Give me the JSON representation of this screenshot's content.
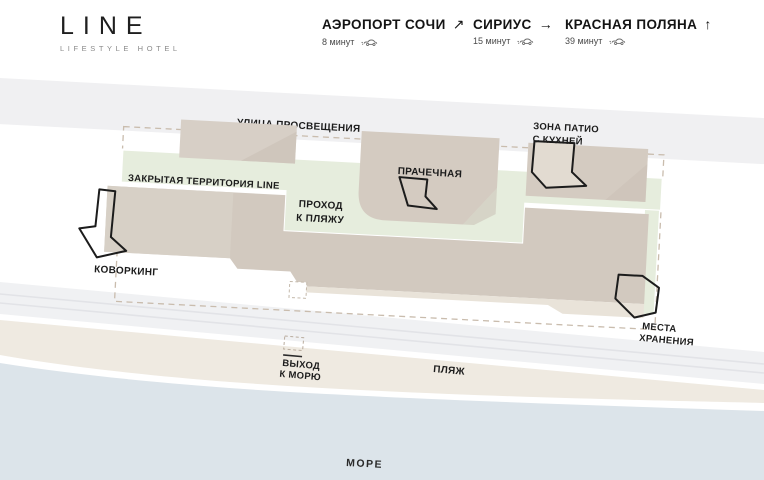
{
  "header": {
    "logo": {
      "title": "LINE",
      "subtitle": "LIFESTYLE HOTEL"
    },
    "destinations": [
      {
        "name": "АЭРОПОРТ СОЧИ",
        "arrow": "↗",
        "time": "8 минут",
        "icon": "car-icon"
      },
      {
        "name": "СИРИУС",
        "arrow": "→",
        "time": "15 минут",
        "icon": "car-icon"
      },
      {
        "name": "КРАСНАЯ ПОЛЯНА",
        "arrow": "↑",
        "time": "39 минут",
        "icon": "car-icon"
      }
    ]
  },
  "map": {
    "labels": {
      "street": "УЛИЦА ПРОСВЕЩЕНИЯ",
      "closed_territory": "ЗАКРЫТАЯ ТЕРРИТОРИЯ LINE",
      "beach_passage_line1": "ПРОХОД",
      "beach_passage_line2": "К ПЛЯЖУ",
      "laundry": "ПРАЧЕЧНАЯ",
      "patio_line1": "ЗОНА ПАТИО",
      "patio_line2": "С КУХНЕЙ",
      "coworking": "КОВОРКИНГ",
      "storage_line1": "МЕСТА",
      "storage_line2": "ХРАНЕНИЯ",
      "sea_exit_line1": "ВЫХОД",
      "sea_exit_line2": "К МОРЮ",
      "beach": "ПЛЯЖ",
      "sea": "МОРЕ"
    },
    "colors": {
      "building": "#d3cabf",
      "building_light": "#d8d1c8",
      "building_shade": "#c9c0b5",
      "terrace": "#e9e3d9",
      "green_area": "#e6eddd",
      "road": "#f0f0f2",
      "beach": "#efeae1",
      "sea": "#dce4ea",
      "boundary_dash": "#c9bcad",
      "marker_outline": "#1c1c1c"
    }
  }
}
